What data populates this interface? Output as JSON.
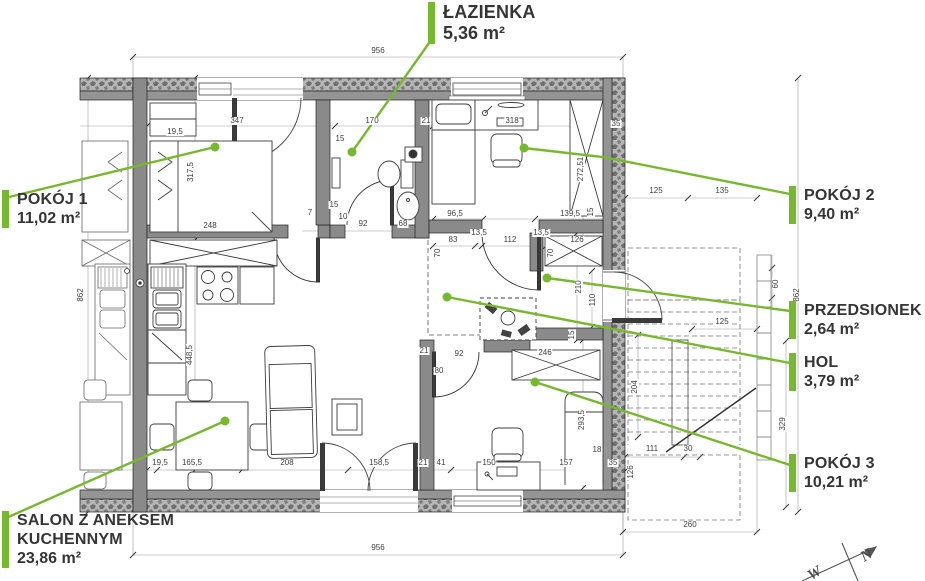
{
  "colors": {
    "leader_green": "#76b82e",
    "wall_fill": "#8f8f8f",
    "hatch_fill": "#b5b5b5",
    "dim_text": "#3f3f3f"
  },
  "rooms": {
    "lazienka": {
      "name": "ŁAZIENKA",
      "area": "5,36 m²"
    },
    "pokoj1": {
      "name": "POKÓJ 1",
      "area": "11,02 m²"
    },
    "pokoj2": {
      "name": "POKÓJ 2",
      "area": "9,40 m²"
    },
    "przedsionek": {
      "name": "PRZEDSIONEK",
      "area": "2,64 m²"
    },
    "hol": {
      "name": "HOL",
      "area": "3,79 m²"
    },
    "pokoj3": {
      "name": "POKÓJ 3",
      "area": "10,21 m²"
    },
    "salon": {
      "name": "SALON Z ANEKSEM KUCHENNYM",
      "area": "23,86 m²"
    }
  },
  "dimensions": [
    {
      "t": "956",
      "x": 378,
      "y": 51
    },
    {
      "t": "19,5",
      "x": 175,
      "y": 132
    },
    {
      "t": "347",
      "x": 237,
      "y": 121
    },
    {
      "t": "170",
      "x": 372,
      "y": 121
    },
    {
      "t": "21",
      "x": 426,
      "y": 121
    },
    {
      "t": "318",
      "x": 512,
      "y": 121
    },
    {
      "t": "35",
      "x": 616,
      "y": 124
    },
    {
      "t": "15",
      "x": 340,
      "y": 139
    },
    {
      "t": "317,5",
      "x": 191,
      "y": 172,
      "r": -90
    },
    {
      "t": "248",
      "x": 210,
      "y": 226
    },
    {
      "t": "96,5",
      "x": 455,
      "y": 214
    },
    {
      "t": "139,5",
      "x": 570,
      "y": 214
    },
    {
      "t": "15",
      "x": 591,
      "y": 212,
      "r": -90
    },
    {
      "t": "272,51",
      "x": 581,
      "y": 169,
      "r": -90
    },
    {
      "t": "7",
      "x": 310,
      "y": 213
    },
    {
      "t": "15",
      "x": 334,
      "y": 205
    },
    {
      "t": "10",
      "x": 343,
      "y": 217
    },
    {
      "t": "92",
      "x": 363,
      "y": 224
    },
    {
      "t": "68",
      "x": 403,
      "y": 224
    },
    {
      "t": "83",
      "x": 453,
      "y": 240
    },
    {
      "t": "13,5",
      "x": 479,
      "y": 233
    },
    {
      "t": "112",
      "x": 510,
      "y": 240
    },
    {
      "t": "13,5",
      "x": 541,
      "y": 233
    },
    {
      "t": "126",
      "x": 577,
      "y": 240
    },
    {
      "t": "70",
      "x": 438,
      "y": 253,
      "r": -90
    },
    {
      "t": "70",
      "x": 551,
      "y": 253,
      "r": -90
    },
    {
      "t": "210",
      "x": 579,
      "y": 287,
      "r": -90
    },
    {
      "t": "110",
      "x": 593,
      "y": 300,
      "r": -90
    },
    {
      "t": "15",
      "x": 572,
      "y": 335,
      "r": -90
    },
    {
      "t": "92",
      "x": 459,
      "y": 354
    },
    {
      "t": "246",
      "x": 545,
      "y": 353
    },
    {
      "t": "80",
      "x": 439,
      "y": 371
    },
    {
      "t": "21",
      "x": 424,
      "y": 351
    },
    {
      "t": "293,5",
      "x": 582,
      "y": 420,
      "r": -90
    },
    {
      "t": "19,5",
      "x": 160,
      "y": 463
    },
    {
      "t": "165,5",
      "x": 192,
      "y": 463
    },
    {
      "t": "208",
      "x": 287,
      "y": 463
    },
    {
      "t": "158,5",
      "x": 379,
      "y": 463
    },
    {
      "t": "21",
      "x": 423,
      "y": 463
    },
    {
      "t": "41",
      "x": 441,
      "y": 463
    },
    {
      "t": "150",
      "x": 489,
      "y": 463
    },
    {
      "t": "157",
      "x": 566,
      "y": 463
    },
    {
      "t": "18",
      "x": 597,
      "y": 450
    },
    {
      "t": "35",
      "x": 613,
      "y": 463
    },
    {
      "t": "448,5",
      "x": 190,
      "y": 355,
      "r": -90
    },
    {
      "t": "862",
      "x": 81,
      "y": 295,
      "r": -90
    },
    {
      "t": "862",
      "x": 797,
      "y": 295,
      "r": -90
    },
    {
      "t": "956",
      "x": 378,
      "y": 548
    },
    {
      "t": "125",
      "x": 656,
      "y": 191
    },
    {
      "t": "135",
      "x": 722,
      "y": 191
    },
    {
      "t": "60",
      "x": 776,
      "y": 284,
      "r": -90
    },
    {
      "t": "125",
      "x": 722,
      "y": 322
    },
    {
      "t": "204",
      "x": 635,
      "y": 387,
      "r": -90
    },
    {
      "t": "329",
      "x": 783,
      "y": 424,
      "r": -90
    },
    {
      "t": "111",
      "x": 652,
      "y": 449
    },
    {
      "t": "30",
      "x": 688,
      "y": 449
    },
    {
      "t": "126",
      "x": 631,
      "y": 472,
      "r": -90
    },
    {
      "t": "260",
      "x": 690,
      "y": 525
    }
  ],
  "compass": {
    "letters": [
      {
        "t": "N",
        "x": 867,
        "y": 556,
        "r": -32
      },
      {
        "t": "W",
        "x": 815,
        "y": 574,
        "r": -32
      }
    ]
  }
}
